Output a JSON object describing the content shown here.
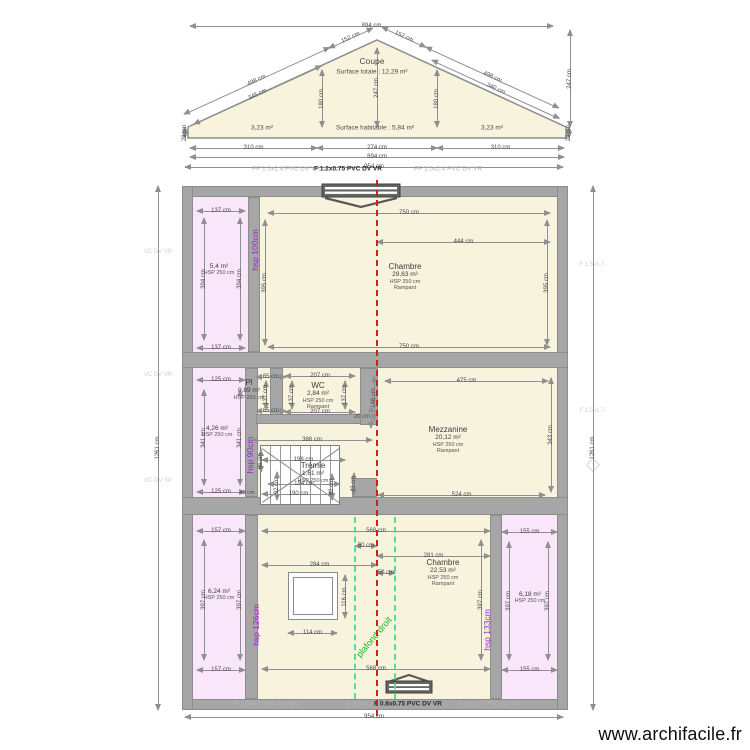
{
  "watermark": "www.archifacile.fr",
  "coupe": {
    "title": "Coupe",
    "surface_totale": "Surface totale : 12,29 m²",
    "surface_habitable": "Surface habitable : 5,84 m²",
    "area_left": "3,23 m²",
    "area_right": "3,23 m²"
  },
  "colors": {
    "wall": "#a6a6a6",
    "room_cream": "#f7f3dc",
    "room_pink": "#f9e6fa",
    "dim_line": "#909090",
    "axis_red": "#cf1f1f",
    "ceiling_green": "#5edb92",
    "hsp_purple": "#a21fd6",
    "plafond_green": "#1db31d"
  },
  "plan": {
    "rooms": [
      {
        "fill": "pink",
        "x": 193,
        "y": 197,
        "w": 55,
        "h": 155
      },
      {
        "fill": "cream",
        "x": 260,
        "y": 197,
        "w": 297,
        "h": 155
      },
      {
        "fill": "pink",
        "x": 193,
        "y": 368,
        "w": 52,
        "h": 129
      },
      {
        "fill": "cream",
        "x": 258,
        "y": 368,
        "w": 299,
        "h": 129
      },
      {
        "fill": "pink",
        "x": 193,
        "y": 515,
        "w": 52,
        "h": 184
      },
      {
        "fill": "cream",
        "x": 258,
        "y": 515,
        "w": 232,
        "h": 184
      },
      {
        "fill": "pink",
        "x": 502,
        "y": 515,
        "w": 55,
        "h": 184
      }
    ],
    "walls": [
      {
        "x": 182,
        "y": 186,
        "w": 386,
        "h": 11
      },
      {
        "x": 182,
        "y": 699,
        "w": 386,
        "h": 11
      },
      {
        "x": 182,
        "y": 186,
        "w": 11,
        "h": 524
      },
      {
        "x": 557,
        "y": 186,
        "w": 11,
        "h": 524
      },
      {
        "x": 182,
        "y": 352,
        "w": 386,
        "h": 16
      },
      {
        "x": 182,
        "y": 497,
        "w": 386,
        "h": 18
      },
      {
        "x": 248,
        "y": 197,
        "w": 12,
        "h": 155
      },
      {
        "x": 245,
        "y": 368,
        "w": 13,
        "h": 129
      },
      {
        "x": 270,
        "y": 368,
        "w": 13,
        "h": 56
      },
      {
        "x": 256,
        "y": 414,
        "w": 111,
        "h": 10
      },
      {
        "x": 360,
        "y": 368,
        "w": 18,
        "h": 57
      },
      {
        "x": 352,
        "y": 478,
        "w": 25,
        "h": 19
      },
      {
        "x": 245,
        "y": 515,
        "w": 13,
        "h": 184
      },
      {
        "x": 490,
        "y": 515,
        "w": 12,
        "h": 184
      }
    ],
    "room_labels": [
      {
        "x": 405,
        "y": 262,
        "t": "Chambre",
        "a": "29,63 m²",
        "h": "HSP 250 cm",
        "r": "Rampant"
      },
      {
        "x": 219,
        "y": 263,
        "a": "5,4 m²",
        "h": "HSP 250 cm"
      },
      {
        "x": 318,
        "y": 381,
        "t": "WC",
        "a": "2,84 m²",
        "h": "HSP 250 cm",
        "r": "Rampant"
      },
      {
        "x": 249,
        "y": 378,
        "t": "Pl",
        "a": "0,89 m²",
        "h": "HSP 250 cm"
      },
      {
        "x": 217,
        "y": 425,
        "a": "4,26 m²",
        "h": "HSP 250 cm"
      },
      {
        "x": 448,
        "y": 425,
        "t": "Mezzanine",
        "a": "20,12 m²",
        "h": "HSP 250 cm",
        "r": "Rampant"
      },
      {
        "x": 313,
        "y": 461,
        "t": "Trémie",
        "a": "1,61 m²",
        "h": "HSP 250 cm"
      },
      {
        "x": 219,
        "y": 588,
        "a": "6,24 m²",
        "h": "HSP 250 cm"
      },
      {
        "x": 443,
        "y": 558,
        "t": "Chambre",
        "a": "22,53 m²",
        "h": "HSP 250 cm",
        "r": "Rampant"
      },
      {
        "x": 530,
        "y": 591,
        "a": "6,18 m²",
        "h": "HSP 250 cm"
      }
    ],
    "dims": [
      {
        "o": "h",
        "x": 190,
        "y": 26,
        "l": 363,
        "t": "894 cm"
      },
      {
        "o": "h",
        "x": 190,
        "y": 148,
        "l": 127,
        "t": "310 cm"
      },
      {
        "o": "h",
        "x": 317,
        "y": 148,
        "l": 120,
        "t": "274 cm"
      },
      {
        "o": "h",
        "x": 437,
        "y": 148,
        "l": 127,
        "t": "310 cm"
      },
      {
        "o": "h",
        "x": 190,
        "y": 157,
        "l": 374,
        "t": "894 cm"
      },
      {
        "o": "h",
        "x": 185,
        "y": 167,
        "l": 378,
        "t": "954 cm"
      },
      {
        "o": "v",
        "x": 322,
        "y": 70,
        "l": 57,
        "t": "180 cm"
      },
      {
        "o": "v",
        "x": 437,
        "y": 70,
        "l": 57,
        "t": "180 cm"
      },
      {
        "o": "v",
        "x": 377,
        "y": 48,
        "l": 79,
        "t": "247 cm"
      },
      {
        "o": "v",
        "x": 570,
        "y": 30,
        "l": 97,
        "t": "247 cm"
      },
      {
        "o": "v",
        "x": 185,
        "y": 127,
        "l": 11,
        "t": "28 cm"
      },
      {
        "o": "v",
        "x": 569,
        "y": 127,
        "l": 11,
        "t": "28 cm"
      },
      {
        "o": "h",
        "x": 184,
        "y": 114,
        "l": 160,
        "t": "498 cm",
        "r": -24.6
      },
      {
        "o": "h",
        "x": 329,
        "y": 48,
        "l": 48,
        "t": "152 cm",
        "r": -24.6
      },
      {
        "o": "h",
        "x": 194,
        "y": 124,
        "l": 140,
        "t": "345 cm",
        "r": -24.6
      },
      {
        "o": "h",
        "x": 382,
        "y": 27,
        "l": 48,
        "t": "152 cm",
        "r": 24.6
      },
      {
        "o": "h",
        "x": 426,
        "y": 47,
        "l": 146,
        "t": "498 cm",
        "r": 24.6
      },
      {
        "o": "h",
        "x": 432,
        "y": 60,
        "l": 140,
        "t": "340 cm",
        "r": 24.6
      },
      {
        "o": "v",
        "x": 158,
        "y": 186,
        "l": 524,
        "t": "1261 cm"
      },
      {
        "o": "v",
        "x": 593,
        "y": 186,
        "l": 524,
        "t": "1261 cm"
      },
      {
        "o": "h",
        "x": 185,
        "y": 717,
        "l": 378,
        "t": "954 cm"
      },
      {
        "o": "h",
        "x": 197,
        "y": 211,
        "l": 48,
        "t": "137 cm"
      },
      {
        "o": "h",
        "x": 197,
        "y": 348,
        "l": 48,
        "t": "137 cm"
      },
      {
        "o": "v",
        "x": 204,
        "y": 218,
        "l": 122,
        "t": "394 cm"
      },
      {
        "o": "v",
        "x": 240,
        "y": 218,
        "l": 122,
        "t": "394 cm"
      },
      {
        "o": "h",
        "x": 268,
        "y": 213,
        "l": 282,
        "t": "750 cm"
      },
      {
        "o": "h",
        "x": 268,
        "y": 347,
        "l": 282,
        "t": "750 cm"
      },
      {
        "o": "h",
        "x": 377,
        "y": 242,
        "l": 173,
        "t": "444 cm"
      },
      {
        "o": "v",
        "x": 265,
        "y": 220,
        "l": 125,
        "t": "395 cm"
      },
      {
        "o": "v",
        "x": 547,
        "y": 220,
        "l": 125,
        "t": "395 cm"
      },
      {
        "o": "h",
        "x": 197,
        "y": 380,
        "l": 48,
        "t": "125 cm"
      },
      {
        "o": "h",
        "x": 197,
        "y": 492,
        "l": 48,
        "t": "125 cm"
      },
      {
        "o": "v",
        "x": 204,
        "y": 390,
        "l": 95,
        "t": "341 cm"
      },
      {
        "o": "v",
        "x": 240,
        "y": 390,
        "l": 95,
        "t": "341 cm"
      },
      {
        "o": "h",
        "x": 256,
        "y": 377,
        "l": 30,
        "t": "65 cm"
      },
      {
        "o": "h",
        "x": 256,
        "y": 411,
        "l": 30,
        "t": "65 cm"
      },
      {
        "o": "v",
        "x": 266,
        "y": 381,
        "l": 28,
        "t": "137 cm"
      },
      {
        "o": "h",
        "x": 285,
        "y": 376,
        "l": 70,
        "t": "207 cm"
      },
      {
        "o": "h",
        "x": 285,
        "y": 412,
        "l": 70,
        "t": "207 cm"
      },
      {
        "o": "v",
        "x": 292,
        "y": 381,
        "l": 28,
        "t": "137 cm"
      },
      {
        "o": "v",
        "x": 345,
        "y": 381,
        "l": 28,
        "t": "137 cm"
      },
      {
        "o": "v",
        "x": 374,
        "y": 376,
        "l": 44,
        "t": "146 cm"
      },
      {
        "o": "v",
        "x": 371,
        "y": 406,
        "l": 22,
        "t": "20 cm",
        "lh": 1
      },
      {
        "o": "h",
        "x": 385,
        "y": 381,
        "l": 163,
        "t": "475 cm"
      },
      {
        "o": "h",
        "x": 378,
        "y": 495,
        "l": 167,
        "t": "524 cm"
      },
      {
        "o": "v",
        "x": 551,
        "y": 378,
        "l": 114,
        "t": "343 cm"
      },
      {
        "o": "h",
        "x": 252,
        "y": 440,
        "l": 120,
        "t": "386 cm"
      },
      {
        "o": "h",
        "x": 262,
        "y": 460,
        "l": 83,
        "t": "198 cm"
      },
      {
        "o": "h",
        "x": 268,
        "y": 484,
        "l": 72,
        "t": "194 cm"
      },
      {
        "o": "h",
        "x": 262,
        "y": 494,
        "l": 73,
        "t": "190 cm"
      },
      {
        "o": "v",
        "x": 261,
        "y": 450,
        "l": 22,
        "t": "66 cm"
      },
      {
        "o": "v",
        "x": 277,
        "y": 472,
        "l": 28,
        "t": "92 cm"
      },
      {
        "o": "v",
        "x": 332,
        "y": 474,
        "l": 26,
        "t": "82 cm"
      },
      {
        "o": "v",
        "x": 354,
        "y": 473,
        "l": 22,
        "t": "43 cm"
      },
      {
        "o": "h",
        "x": 197,
        "y": 531,
        "l": 48,
        "t": "157 cm"
      },
      {
        "o": "h",
        "x": 197,
        "y": 670,
        "l": 48,
        "t": "157 cm"
      },
      {
        "o": "v",
        "x": 204,
        "y": 540,
        "l": 120,
        "t": "397 cm"
      },
      {
        "o": "v",
        "x": 240,
        "y": 540,
        "l": 120,
        "t": "397 cm"
      },
      {
        "o": "h",
        "x": 262,
        "y": 531,
        "l": 228,
        "t": "568 cm"
      },
      {
        "o": "h",
        "x": 262,
        "y": 669,
        "l": 228,
        "t": "568 cm"
      },
      {
        "o": "h",
        "x": 355,
        "y": 546,
        "l": 22,
        "t": "50 cm"
      },
      {
        "o": "h",
        "x": 377,
        "y": 573,
        "l": 18,
        "t": "50 cm"
      },
      {
        "o": "h",
        "x": 262,
        "y": 565,
        "l": 115,
        "t": "284 cm"
      },
      {
        "o": "h",
        "x": 377,
        "y": 556,
        "l": 113,
        "t": "281 cm"
      },
      {
        "o": "h",
        "x": 288,
        "y": 633,
        "l": 49,
        "t": "114 cm"
      },
      {
        "o": "v",
        "x": 345,
        "y": 575,
        "l": 43,
        "t": "116 cm"
      },
      {
        "o": "v",
        "x": 481,
        "y": 540,
        "l": 120,
        "t": "397 cm"
      },
      {
        "o": "h",
        "x": 502,
        "y": 532,
        "l": 55,
        "t": "155 cm"
      },
      {
        "o": "h",
        "x": 502,
        "y": 670,
        "l": 55,
        "t": "155 cm"
      },
      {
        "o": "v",
        "x": 509,
        "y": 542,
        "l": 118,
        "t": "397 cm"
      },
      {
        "o": "v",
        "x": 548,
        "y": 542,
        "l": 118,
        "t": "397 cm"
      }
    ],
    "texts": [
      {
        "t": "Coupe",
        "x": 372,
        "y": 61,
        "c": "coupe-title"
      },
      {
        "t": "Surface totale : 12,29 m²",
        "x": 372,
        "y": 72,
        "c": "coupe-sub"
      },
      {
        "t": "3,23 m²",
        "x": 262,
        "y": 128,
        "c": "coupe-area"
      },
      {
        "t": "Surface habitable : 5,84 m²",
        "x": 375,
        "y": 128,
        "c": "coupe-area"
      },
      {
        "t": "3,23 m²",
        "x": 492,
        "y": 128,
        "c": "coupe-area"
      },
      {
        "t": "PF 1.5x2.4 PVC DV VR",
        "x": 286,
        "y": 169,
        "c": "wl-gray"
      },
      {
        "t": "F 1.2x0.75 PVC DV VR",
        "x": 348,
        "y": 169,
        "c": "wl-dark"
      },
      {
        "t": "PF 1.5x2.4 PVC DV VR",
        "x": 448,
        "y": 169,
        "c": "wl-gray"
      },
      {
        "t": "F 1.5x1.7 PVC DV VR",
        "x": 266,
        "y": 704,
        "c": "wl-gray"
      },
      {
        "t": "F 1.5x1.7 PV",
        "x": 366,
        "y": 704,
        "c": "wl-gray"
      },
      {
        "t": "F 0.8x0.75 PVC DV VR",
        "x": 408,
        "y": 704,
        "c": "wl-dark"
      },
      {
        "t": "F 1.5x1.7 PVC DV VR",
        "x": 489,
        "y": 704,
        "c": "wl-gray"
      },
      {
        "t": "VC DV VR",
        "x": 158,
        "y": 252,
        "c": "wl-faint"
      },
      {
        "t": "VC DV VR",
        "x": 158,
        "y": 375,
        "c": "wl-faint"
      },
      {
        "t": "VC DV SP",
        "x": 158,
        "y": 481,
        "c": "wl-faint"
      },
      {
        "t": "F 1.5x1.7",
        "x": 592,
        "y": 265,
        "c": "wl-faint"
      },
      {
        "t": "F 1.5x1.7",
        "x": 592,
        "y": 411,
        "c": "wl-faint"
      },
      {
        "t": "hsp 100cm",
        "x": 255,
        "y": 250,
        "c": "hsp",
        "r": -90
      },
      {
        "t": "hsp 90cm",
        "x": 250,
        "y": 455,
        "c": "hsp",
        "r": -90
      },
      {
        "t": "hsp 126cm",
        "x": 256,
        "y": 625,
        "c": "hsp",
        "r": -90
      },
      {
        "t": "hsp 133cm",
        "x": 487,
        "y": 630,
        "c": "hsp",
        "r": -90
      },
      {
        "t": "plafond droit",
        "x": 374,
        "y": 637,
        "c": "plafond",
        "r": -50
      },
      {
        "t": "40 cm",
        "x": 247,
        "y": 493,
        "c": "dim-lbl"
      }
    ],
    "axes": {
      "red_x": 376,
      "red_y1": 180,
      "red_y2": 716,
      "green_x1": 354,
      "green_x2": 394,
      "green_y1": 517,
      "green_y2": 699
    }
  }
}
